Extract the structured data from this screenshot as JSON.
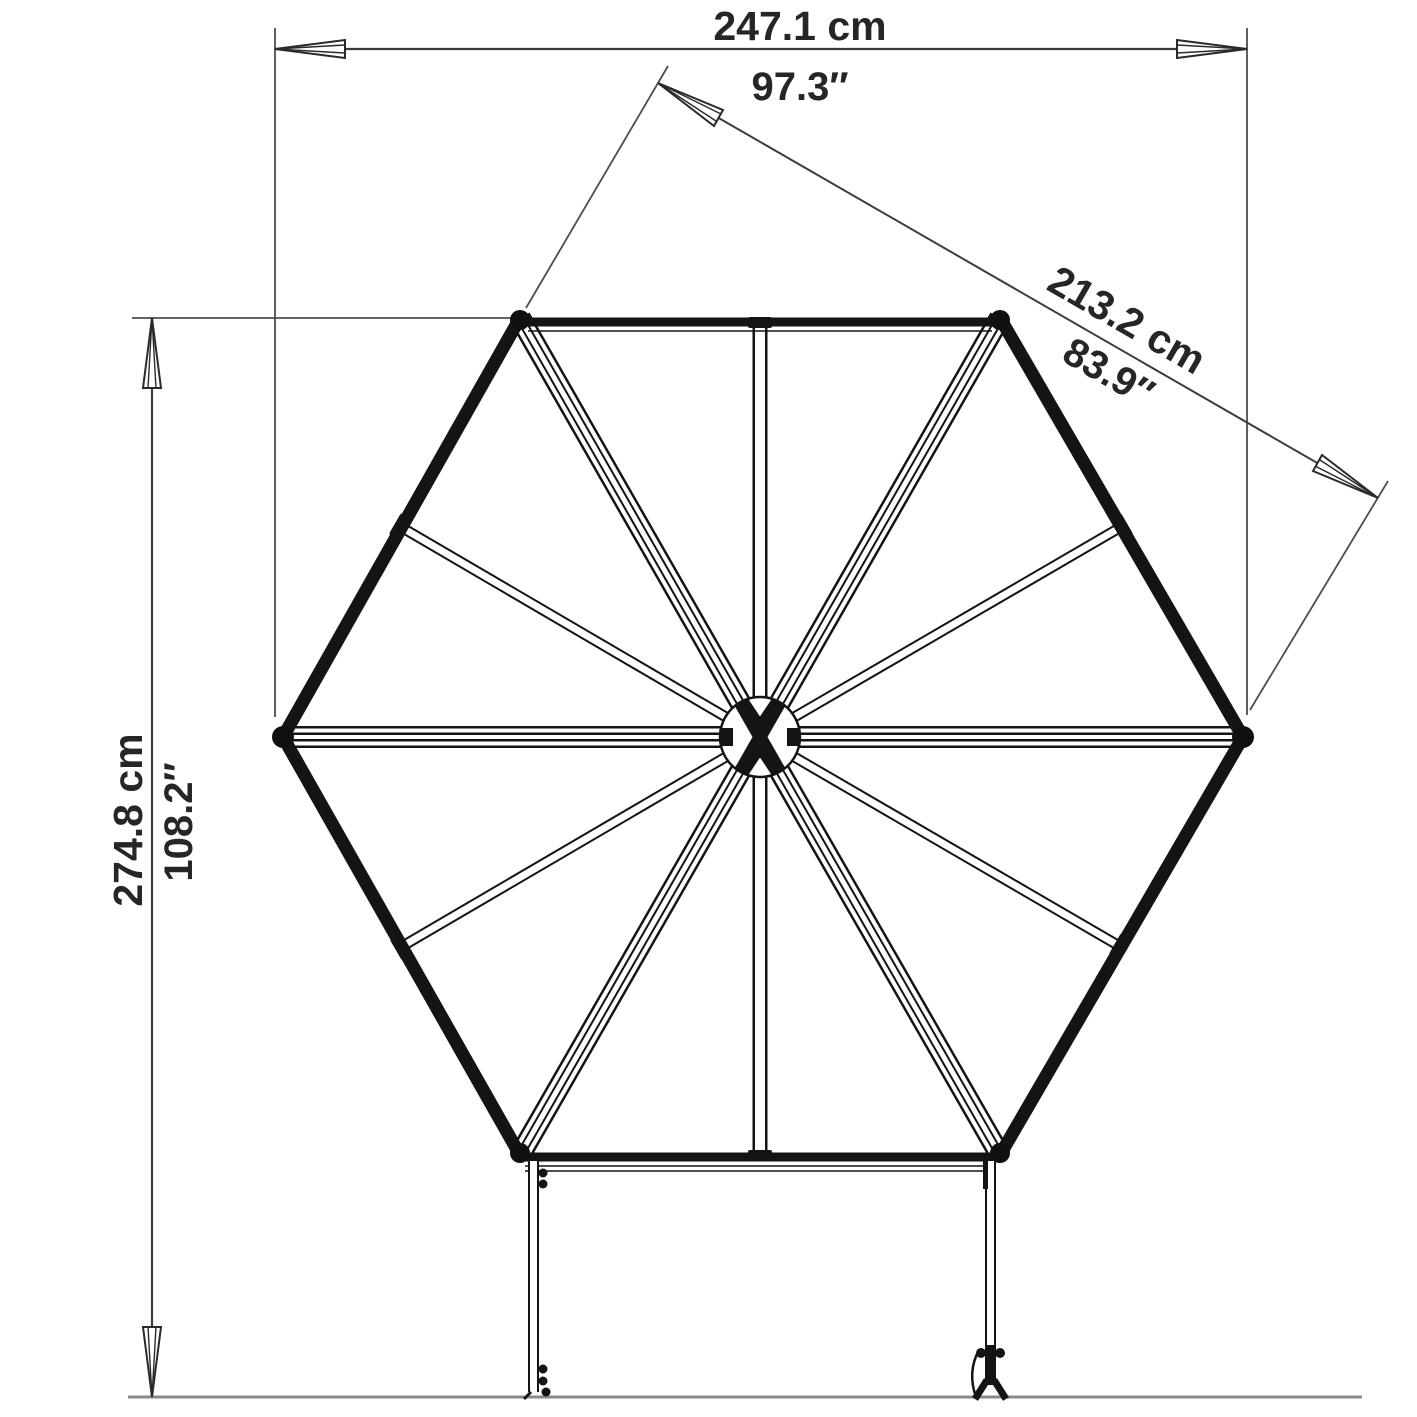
{
  "drawing": {
    "title": "Hexagonal structure top-view dimension drawing",
    "shape": "hexagon-roof-plan-with-radial-spokes",
    "units": [
      "cm",
      "inches"
    ],
    "dimensions": {
      "width": {
        "cm": "247.1 cm",
        "inches": "97.3″",
        "orientation": "horizontal-top"
      },
      "diagonal": {
        "cm": "213.2 cm",
        "inches": "83.9″",
        "orientation": "diagonal-30deg"
      },
      "height": {
        "cm": "274.8 cm",
        "inches": "108.2″",
        "orientation": "vertical-left"
      }
    },
    "colors": {
      "frame_line": "#141414",
      "dimension_line": "#3c3c3c",
      "extension_line": "#4d4d4d",
      "ground_line": "#8a8a8a",
      "text": "#262626",
      "background": "#ffffff"
    }
  }
}
